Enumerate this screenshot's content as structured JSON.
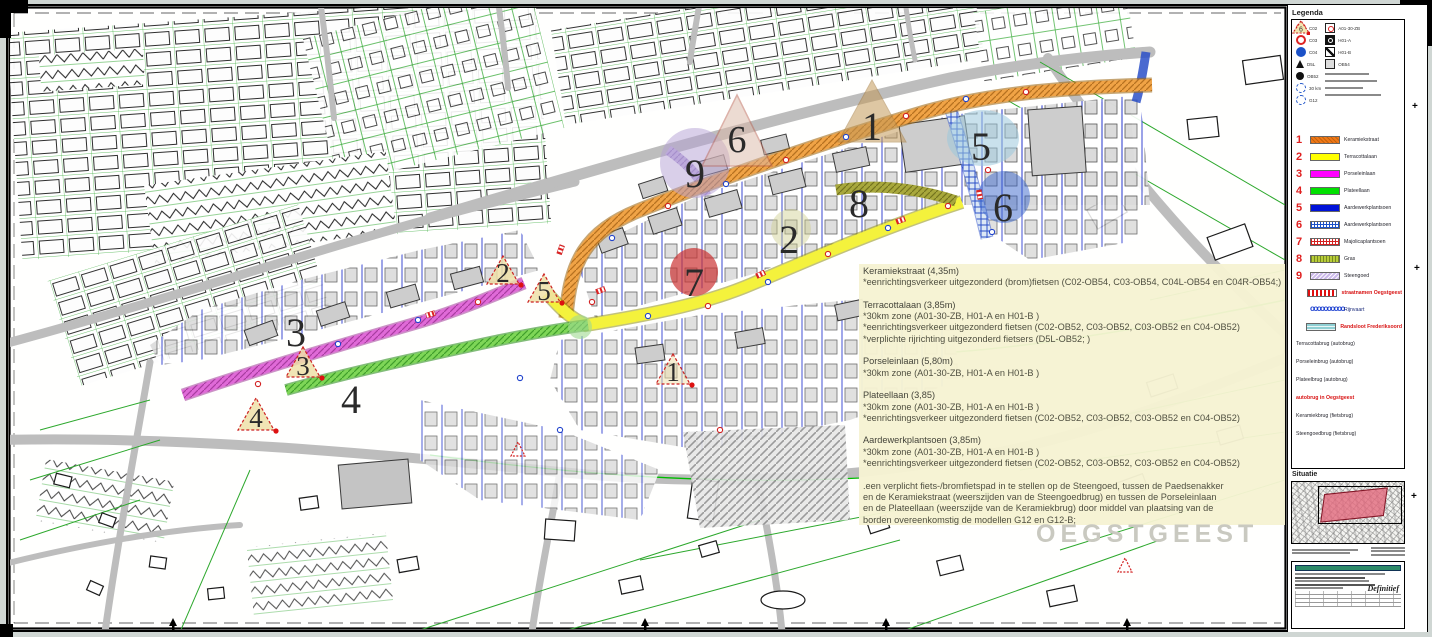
{
  "page": {
    "watermark": "OEGSTGEEST"
  },
  "colors": {
    "keramiekstraat": "#F07818",
    "terracottalaan": "#FFFF00",
    "porseleinlaan": "#FF00FF",
    "plateellaan": "#00E000",
    "aardewerkplantsoen": "#0012D8",
    "aardewerkplantsoen_hatch": "#1B51C8",
    "majolicaplantsoen": "#D42222",
    "gras": "#B8CC3A",
    "steengoed": "#CBB8EA",
    "straatnamen": "#E01010",
    "rijnvaart": "#1B3FD0",
    "randsloot": "#8FD0D4",
    "annotation_bg": "#F6F3D2",
    "legend_number_red": "#E02020"
  },
  "legend": {
    "title": "Legenda",
    "signs_left": [
      {
        "code": "C02"
      },
      {
        "code": "C03"
      },
      {
        "code": "C04"
      },
      {
        "code": "D5L"
      },
      {
        "code": "OB52"
      },
      {
        "code": "30 km"
      },
      {
        "code": "G12"
      }
    ],
    "signs_right": [
      {
        "code": "A01-30-ZB"
      },
      {
        "code": "H01-A"
      },
      {
        "code": "H01-B"
      },
      {
        "code": "OB54"
      }
    ],
    "streets": [
      {
        "num": "1",
        "label": "Keramiekstraat"
      },
      {
        "num": "2",
        "label": "Terracottalaan"
      },
      {
        "num": "3",
        "label": "Porseleinlaan"
      },
      {
        "num": "4",
        "label": "Plateellaan"
      },
      {
        "num": "5",
        "label": "Aardewerkplantsoen"
      },
      {
        "num": "6",
        "label": "Aardewerkplantsoen"
      },
      {
        "num": "7",
        "label": "Majolicaplantsoen"
      },
      {
        "num": "8",
        "label": "Gras"
      },
      {
        "num": "9",
        "label": "Steengoed"
      }
    ],
    "streetnames_row": {
      "label": "straatnamen Oegstgeest"
    },
    "water": [
      {
        "label": "Rijnvaart",
        "dots": "oooooooooo"
      },
      {
        "label": "Randsloot Frederiksoord"
      }
    ],
    "bridges": [
      {
        "num": "1",
        "label": "Terracottabrug (autobrug)"
      },
      {
        "num": "2",
        "label": "Porseleinbrug (autobrug)"
      },
      {
        "num": "3",
        "label": "Plateelbrug (autobrug)"
      },
      {
        "num": "4",
        "label": "autobrug in Oegstgeest",
        "red": true
      },
      {
        "num": "5",
        "label": "Keramiekbrug (fietsbrug)"
      },
      {
        "num": "6",
        "label": "Steengoedbrug (fietsbrug)"
      }
    ],
    "situatie_title": "Situatie",
    "status": "Definitief"
  },
  "map": {
    "markers": [
      {
        "label": "1"
      },
      {
        "label": "2"
      },
      {
        "label": "3"
      },
      {
        "label": "4"
      },
      {
        "label": "5"
      },
      {
        "label": "6"
      },
      {
        "label": "7"
      },
      {
        "label": "8"
      },
      {
        "label": "9"
      },
      {
        "label": "6"
      },
      {
        "label": "2"
      },
      {
        "label": "5"
      },
      {
        "label": "3"
      },
      {
        "label": "4"
      },
      {
        "label": "1"
      }
    ],
    "annotation": {
      "lines": [
        "Keramiekstraat (4,35m)",
        "*eenrichtingsverkeer uitgezonderd (brom)fietsen (C02-OB54, C03-OB54, C04L-OB54 en C04R-OB54;)",
        "",
        "Terracottalaan (3,85m)",
        "*30km zone (A01-30-ZB, H01-A en H01-B )",
        "*eenrichtingsverkeer uitgezonderd fietsen (C02-OB52, C03-OB52, C03-OB52 en C04-OB52)",
        "*verplichte rijrichting uitgezonderd fietsers (D5L-OB52; )",
        "",
        "Porseleinlaan  (5,80m)",
        "*30km zone (A01-30-ZB, H01-A en H01-B )",
        "",
        "Plateellaan (3,85)",
        "*30km zone (A01-30-ZB, H01-A en H01-B )",
        "*eenrichtingsverkeer uitgezonderd fietsen (C02-OB52, C03-OB52, C03-OB52 en C04-OB52)",
        "",
        "Aardewerkplantsoen (3,85m)",
        "*30km zone (A01-30-ZB, H01-A en H01-B )",
        "*eenrichtingsverkeer uitgezonderd fietsen (C02-OB52, C03-OB52, C03-OB52 en C04-OB52)",
        "",
        ".een verplicht fiets-/bromfietspad in te stellen op de Steengoed, tussen de Paedsenakker",
        "en de Keramiekstraat (weerszijden van de Steengoedbrug) en tussen de Porseleinlaan",
        "en de Plateellaan (weerszijde van de Keramiekbrug) door middel van plaatsing van de",
        "borden overeenkomstig de modellen G12 en G12-B;"
      ]
    }
  }
}
